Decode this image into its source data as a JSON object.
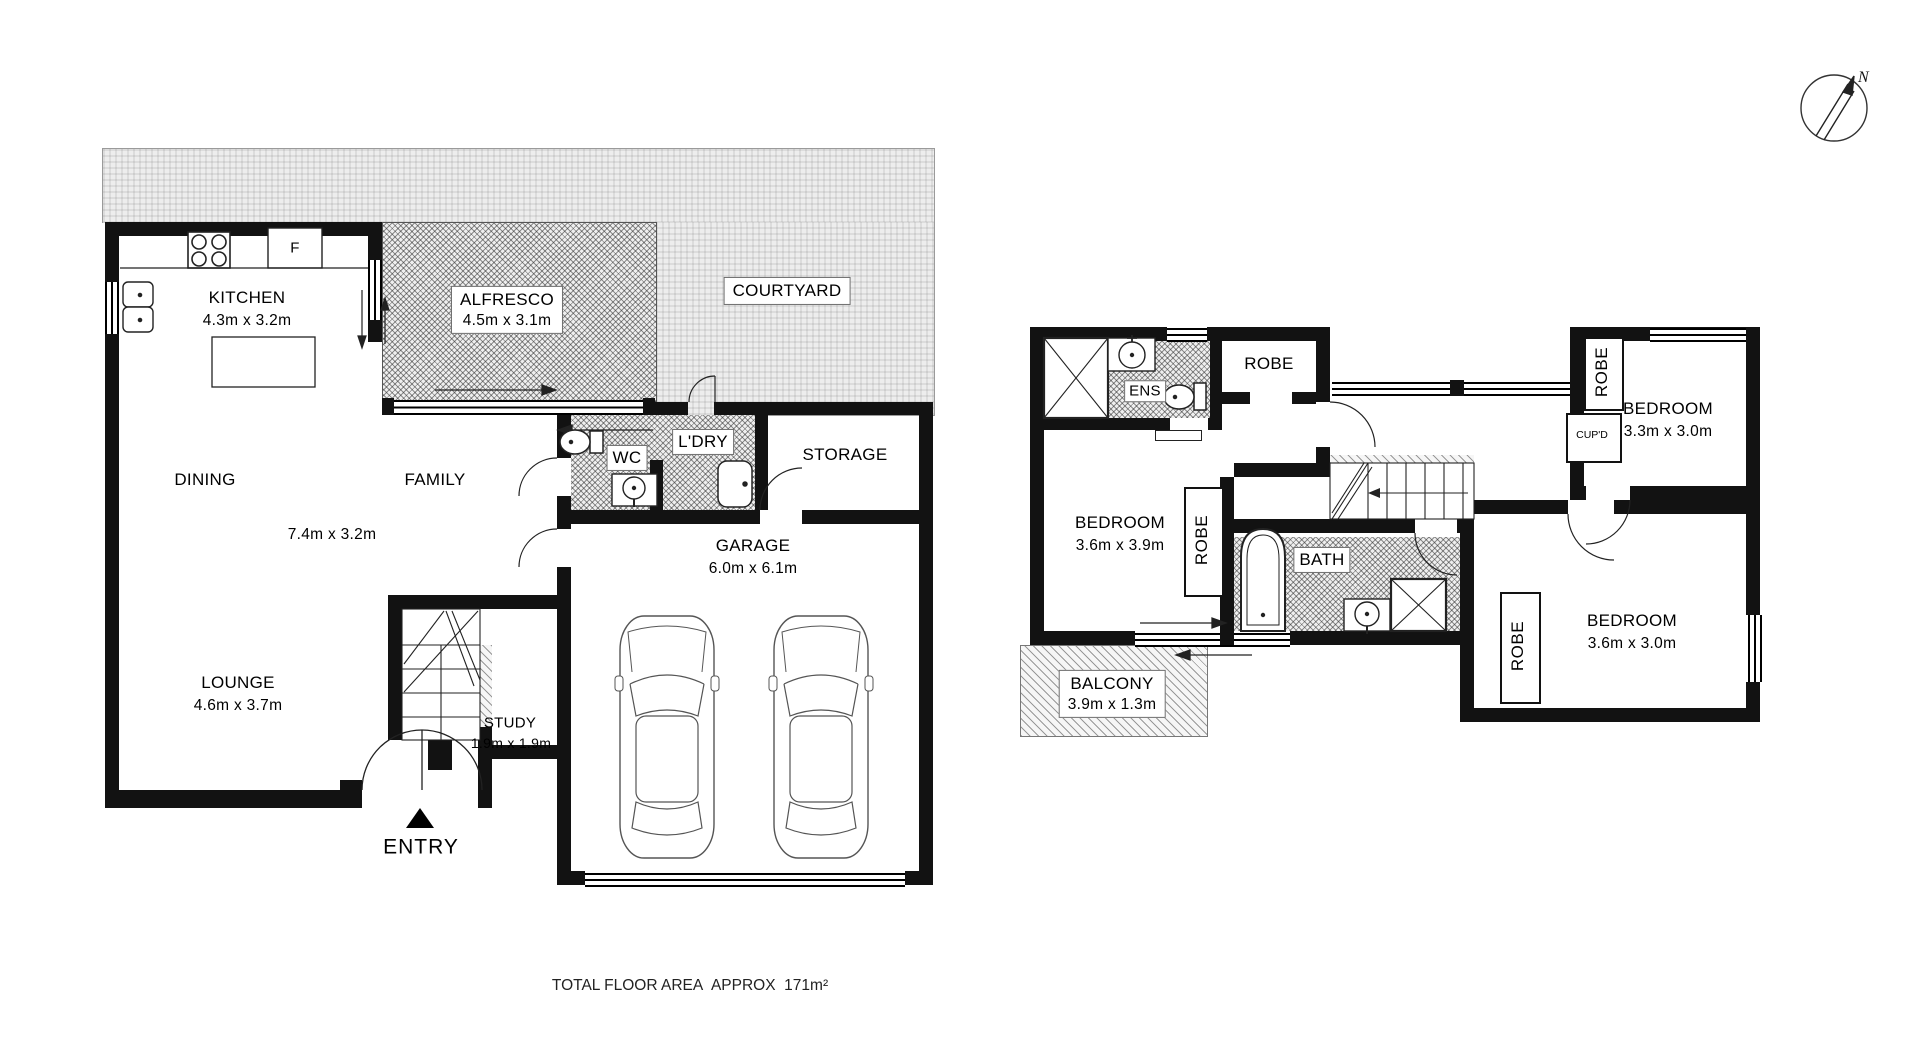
{
  "meta": {
    "footer": "TOTAL FLOOR AREA  APPROX  171m²",
    "compass_label": "N"
  },
  "ground_floor": {
    "kitchen": {
      "name": "KITCHEN",
      "dims": "4.3m x 3.2m"
    },
    "fridge_label": "F",
    "alfresco": {
      "name": "ALFRESCO",
      "dims": "4.5m x 3.1m"
    },
    "courtyard": {
      "name": "COURTYARD"
    },
    "dining": {
      "name": "DINING"
    },
    "family": {
      "name": "FAMILY"
    },
    "dining_family_dims": "7.4m x 3.2m",
    "lounge": {
      "name": "LOUNGE",
      "dims": "4.6m x 3.7m"
    },
    "wc": {
      "name": "WC"
    },
    "laundry": {
      "name": "L'DRY"
    },
    "storage": {
      "name": "STORAGE"
    },
    "garage": {
      "name": "GARAGE",
      "dims": "6.0m x 6.1m"
    },
    "study": {
      "name": "STUDY",
      "dims": "1.9m x 1.9m"
    },
    "entry": {
      "name": "ENTRY"
    }
  },
  "first_floor": {
    "ensuite": {
      "name": "ENS"
    },
    "robe_walkin": {
      "name": "ROBE"
    },
    "bedroom_main": {
      "name": "BEDROOM",
      "dims": "3.6m x 3.9m"
    },
    "robe_main": {
      "name": "ROBE"
    },
    "cupboard": {
      "name": "CUP'D"
    },
    "robe_top_right": {
      "name": "ROBE"
    },
    "bedroom_top_right": {
      "name": "BEDROOM",
      "dims": "3.3m x 3.0m"
    },
    "bath": {
      "name": "BATH"
    },
    "robe_bottom_right": {
      "name": "ROBE"
    },
    "bedroom_bottom_right": {
      "name": "BEDROOM",
      "dims": "3.6m x 3.0m"
    },
    "balcony": {
      "name": "BALCONY",
      "dims": "3.9m x 1.3m"
    }
  },
  "colors": {
    "wall": "#121212",
    "hatch_line": "#555555",
    "courtyard_bg": "#ededed"
  }
}
